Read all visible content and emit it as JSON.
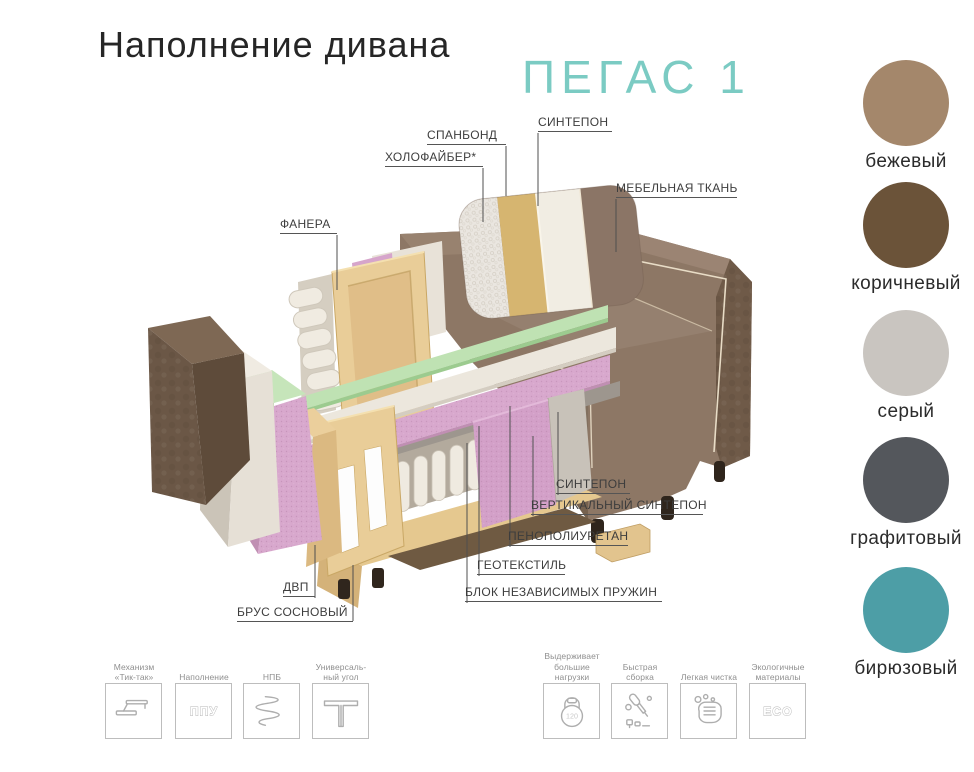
{
  "header": {
    "title": "Наполнение дивана",
    "model": "ПЕГАС 1"
  },
  "colors": {
    "accent_teal": "#7bcbc3",
    "label_text": "#3d3d3d",
    "sofa_brown": "#8d7765",
    "foam_pink": "#d8a8cd",
    "foam_green": "#bfe2b3"
  },
  "diagram": {
    "labels": [
      {
        "text": "СПАНБОНД"
      },
      {
        "text": "СИНТЕПОН"
      },
      {
        "text": "ХОЛОФАЙБЕР*"
      },
      {
        "text": "МЕБЕЛЬНАЯ ТКАНЬ"
      },
      {
        "text": "ФАНЕРА"
      },
      {
        "text": "СИНТЕПОН"
      },
      {
        "text": "ВЕРТИКАЛЬНЫЙ СИНТЕПОН"
      },
      {
        "text": "ПЕНОПОЛИУРЕТАН"
      },
      {
        "text": "ГЕОТЕКСТИЛЬ"
      },
      {
        "text": "БЛОК НЕЗАВИСИМЫХ ПРУЖИН"
      },
      {
        "text": "ДВП"
      },
      {
        "text": "БРУС СОСНОВЫЙ"
      }
    ]
  },
  "swatches": [
    {
      "name": "бежевый",
      "color": "#a4876b"
    },
    {
      "name": "коричневый",
      "color": "#6b5339"
    },
    {
      "name": "серый",
      "color": "#c9c5c0"
    },
    {
      "name": "графитовый",
      "color": "#54575c"
    },
    {
      "name": "бирюзовый",
      "color": "#4d9ea6"
    }
  ],
  "features": [
    {
      "label": "Механизм\n«Тик-так»"
    },
    {
      "label": "Наполнение",
      "icon_text": "ППУ"
    },
    {
      "label": "НПБ"
    },
    {
      "label": "Универсаль-\nный угол"
    },
    {
      "label": "Выдерживает\nбольшие\nнагрузки",
      "icon_text": "120"
    },
    {
      "label": "Быстрая\nсборка"
    },
    {
      "label": "Легкая чистка"
    },
    {
      "label": "Экологичные\nматериалы",
      "icon_text": "ECO"
    }
  ]
}
